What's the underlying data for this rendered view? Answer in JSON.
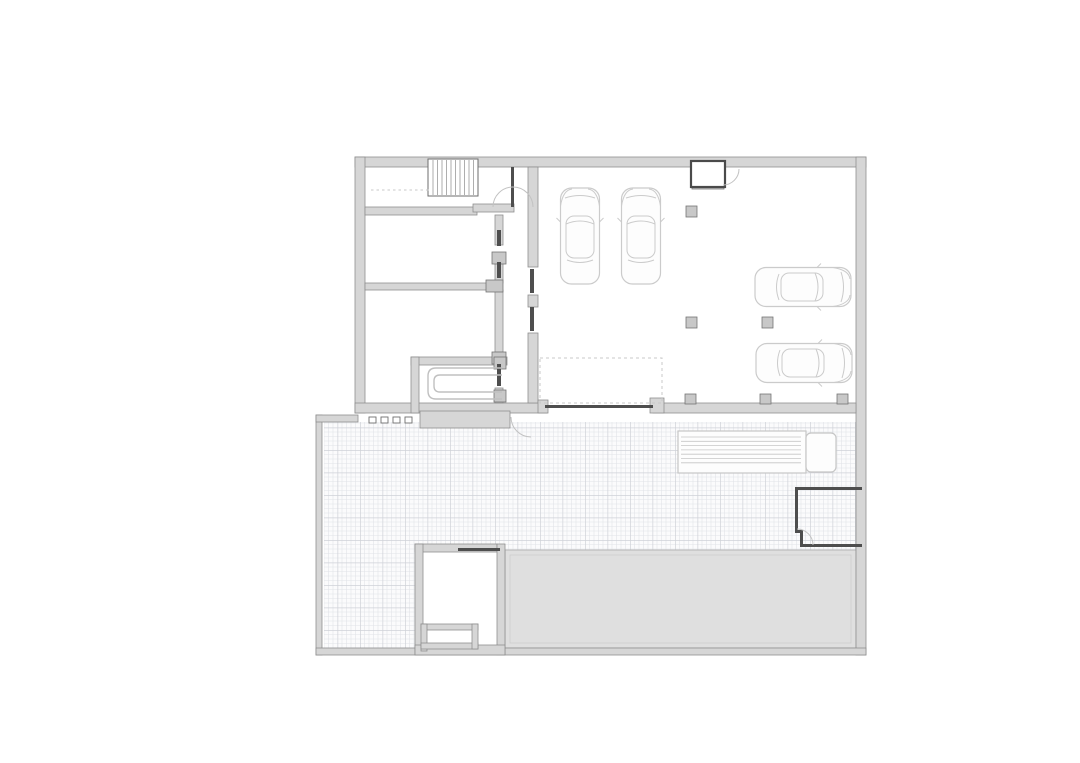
{
  "plan": {
    "canvas": {
      "width": 1080,
      "height": 763,
      "background": "#ffffff"
    },
    "palette": {
      "wall_fill": "#d6d6d6",
      "wall_stroke": "#8f8f8f",
      "dark": "#4e4e4e",
      "block_fill": "#c8c8c8",
      "block_stroke": "#757575",
      "white_fill": "#ffffff",
      "thin_stroke": "#6e6e6e",
      "hatch_fine": "#e2e4e8",
      "hatch_major": "#cfd2d8",
      "hatch_bg": "#fbfbfc",
      "driveway_fill": "#dfdfdf",
      "driveway_stroke": "#b5b5b5",
      "driveway_inner": "#cccccc",
      "car_stroke": "#cbcbcb",
      "truck_stroke": "#c6c6c6",
      "arc_stroke": "#c2c2c2",
      "u_stroke": "#c0c0c0",
      "dash_stroke": "#c8c8c8",
      "tread_stroke": "#9a9a9a",
      "elevator_stroke": "#4a4a4a"
    },
    "hatch": {
      "cell": 4.5,
      "major_every": 5
    },
    "layers": {
      "hatch_rects": [
        [
          324,
          422,
          532,
          128
        ],
        [
          324,
          550,
          91,
          98
        ]
      ],
      "driveway": {
        "rect": [
          505,
          550,
          351,
          98
        ],
        "inner": [
          510,
          555,
          341,
          88
        ]
      },
      "white_fills": [
        [
          423,
          552,
          74,
          93
        ]
      ],
      "walls": [
        [
          355,
          157,
          511,
          10
        ],
        [
          355,
          157,
          10,
          256
        ],
        [
          856,
          157,
          10,
          498
        ],
        [
          355,
          403,
          192,
          10
        ],
        [
          653,
          403,
          203,
          10
        ],
        [
          365,
          207,
          112,
          8
        ],
        [
          473,
          204,
          41,
          8
        ],
        [
          365,
          283,
          123,
          7
        ],
        [
          495,
          215,
          8,
          30
        ],
        [
          495,
          260,
          8,
          23
        ],
        [
          495,
          290,
          8,
          62
        ],
        [
          495,
          388,
          8,
          15
        ],
        [
          528,
          167,
          10,
          100
        ],
        [
          528,
          295,
          10,
          12
        ],
        [
          528,
          333,
          10,
          70
        ],
        [
          316,
          415,
          6,
          240
        ],
        [
          316,
          415,
          42,
          7
        ],
        [
          316,
          648,
          550,
          7
        ],
        [
          415,
          544,
          82,
          8
        ],
        [
          415,
          544,
          8,
          111
        ],
        [
          497,
          544,
          8,
          111
        ],
        [
          415,
          645,
          90,
          10
        ],
        [
          421,
          624,
          57,
          6
        ],
        [
          421,
          624,
          6,
          27
        ],
        [
          421,
          643,
          57,
          6
        ],
        [
          472,
          624,
          6,
          25
        ],
        [
          538,
          400,
          10,
          13
        ],
        [
          650,
          398,
          14,
          15
        ],
        [
          411,
          357,
          96,
          8
        ],
        [
          411,
          357,
          8,
          56
        ],
        [
          420,
          411,
          90,
          17
        ]
      ],
      "blocks": [
        [
          686,
          206,
          11,
          11
        ],
        [
          686,
          317,
          11,
          11
        ],
        [
          762,
          317,
          11,
          11
        ],
        [
          685,
          394,
          11,
          10
        ],
        [
          760,
          394,
          11,
          10
        ],
        [
          837,
          394,
          11,
          10
        ],
        [
          692,
          184,
          32,
          5
        ],
        [
          492,
          252,
          14,
          12
        ],
        [
          492,
          352,
          14,
          12
        ],
        [
          486,
          280,
          17,
          12
        ],
        [
          494,
          357,
          12,
          12
        ],
        [
          494,
          390,
          12,
          12
        ]
      ],
      "darks": [
        [
          497,
          230,
          4,
          16
        ],
        [
          497,
          262,
          4,
          16
        ],
        [
          497,
          364,
          4,
          22
        ],
        [
          530,
          269,
          4,
          24
        ],
        [
          530,
          307,
          4,
          24
        ],
        [
          511,
          167,
          3,
          40
        ],
        [
          545,
          405,
          108,
          3
        ],
        [
          458,
          548,
          42,
          3
        ],
        [
          795,
          487,
          67,
          3
        ],
        [
          795,
          487,
          3,
          46
        ],
        [
          795,
          530,
          8,
          3
        ],
        [
          800,
          530,
          3,
          17
        ],
        [
          800,
          544,
          62,
          3
        ]
      ],
      "white_boxes": [
        [
          428,
          159,
          50,
          37
        ]
      ],
      "window_ticks": [
        [
          369,
          417,
          7,
          6
        ],
        [
          381,
          417,
          7,
          6
        ],
        [
          393,
          417,
          7,
          6
        ],
        [
          405,
          417,
          7,
          6
        ]
      ],
      "elevator": {
        "box": [
          691,
          161,
          34,
          26
        ]
      },
      "stairs": {
        "x0": 433,
        "x1": 474,
        "step": 4.5,
        "y0": 160,
        "y1": 195
      },
      "dashed_rects": [
        [
          540,
          358,
          122,
          45
        ]
      ],
      "dashed_lines": [
        [
          371,
          190,
          429,
          190
        ]
      ],
      "arcs": [
        "M 513 187 A 20 20 0 0 1 533 207",
        "M 513 187 A 20 20 0 0 0 493 207",
        "M 739 169 A 16 16 0 0 1 723 185",
        "M 511 417 A 20 20 0 0 0 531 437",
        "M 797 529 A 16 16 0 0 1 813 545"
      ],
      "u_lines": [
        "M 502 368 L 436 368 Q 428 368 428 376 L 428 391 Q 428 399 436 399 L 502 399",
        "M 502 375 L 440 375 Q 434 375 434 381 L 434 386 Q 434 392 440 392 L 502 392"
      ],
      "cars": [
        {
          "cx": 580,
          "cy": 236,
          "rot": -90
        },
        {
          "cx": 641,
          "cy": 236,
          "rot": -90
        },
        {
          "cx": 803,
          "cy": 287,
          "rot": 0
        },
        {
          "cx": 804,
          "cy": 363,
          "rot": 0
        }
      ],
      "truck": {
        "body": [
          678,
          431,
          128,
          42
        ],
        "cab": [
          806,
          433,
          30,
          39
        ],
        "stripes": {
          "x1": 681,
          "x2": 801,
          "y1": 437,
          "y2": 467,
          "step": 4.3
        }
      }
    }
  }
}
